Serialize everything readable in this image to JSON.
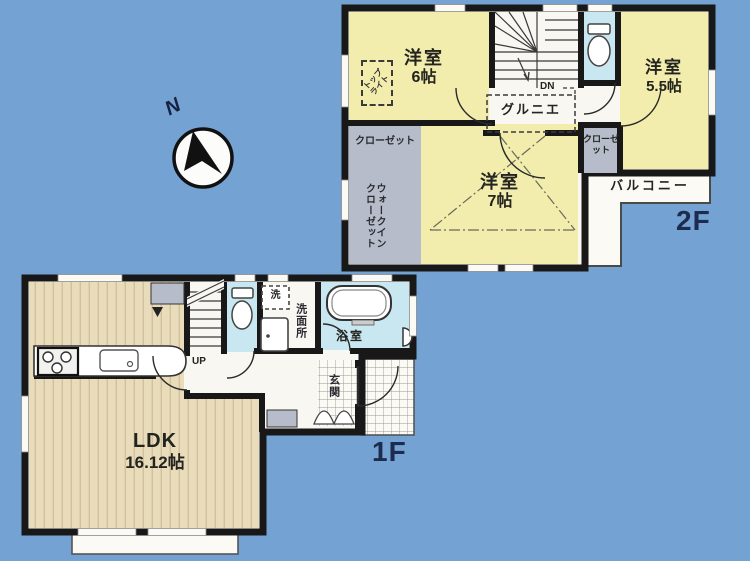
{
  "title": "floor-plan",
  "colors": {
    "background_blue": "#74a2d3",
    "room_yellow": "#f2edad",
    "closet_gray": "#b6bcca",
    "water_blue": "#c9e7f0",
    "wood_floor": "#e9dcba",
    "plan_white": "#f8f7f2",
    "wall_black": "#181818",
    "floor_label_navy": "#1d2c4e"
  },
  "compass": {
    "north_label": "N"
  },
  "floor2": {
    "floor_label": "2F",
    "room_a_name": "洋室",
    "room_a_size": "6帖",
    "room_b_name": "洋室",
    "room_b_size": "5.5帖",
    "room_c_name": "洋室",
    "room_c_size": "7帖",
    "closet_left": "クローゼット",
    "closet_right": "クローゼット",
    "walkin_line1": "ウォークイン",
    "walkin_line2": "クローゼット",
    "balcony": "バルコニー",
    "grenier": "グルニエ",
    "stairs_down": "DN",
    "toplight_line1": "トップ",
    "toplight_line2": "ライト"
  },
  "floor1": {
    "floor_label": "1F",
    "ldk_name": "LDK",
    "ldk_size": "16.12帖",
    "stairs_up": "UP",
    "washer": "洗",
    "washroom": "洗面所",
    "bathroom": "浴室",
    "entrance": "玄関"
  }
}
